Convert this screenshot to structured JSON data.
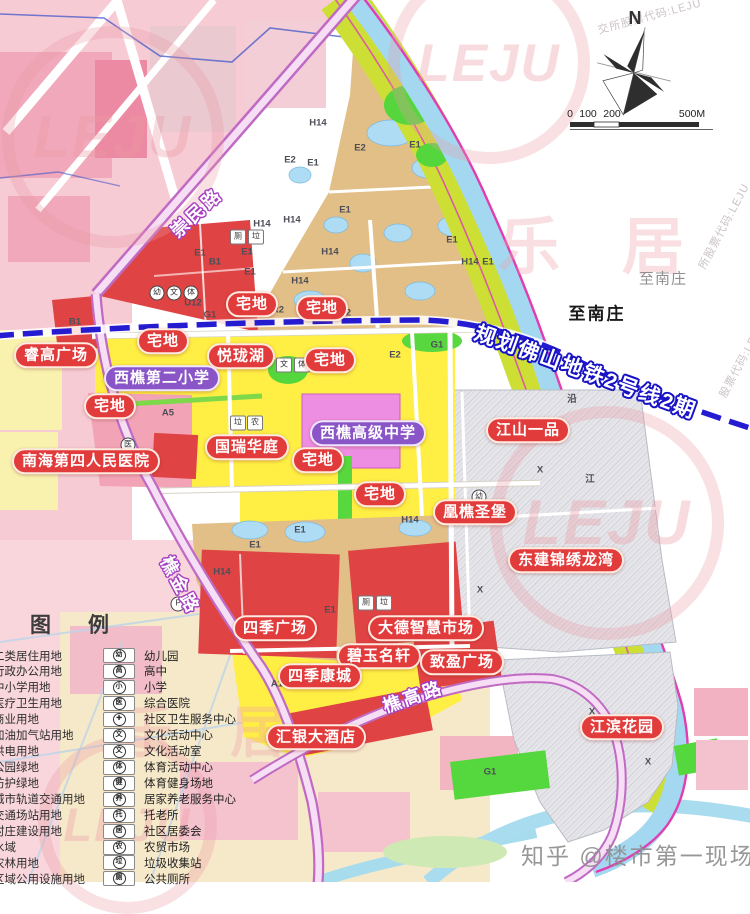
{
  "colors": {
    "bubble_red": "#e23b3b",
    "bubble_purple": "#8a55c6",
    "metro_blue": "#251bd1",
    "road_purple": "#c06ac4",
    "boundary_magenta": "#e23cb3"
  },
  "compass": {
    "label": "N"
  },
  "scale_bar": {
    "ticks": [
      "0",
      "100",
      "200",
      "500M"
    ]
  },
  "destinations": [
    {
      "text": "至南庄",
      "style": "faint",
      "x": 663,
      "y": 278
    },
    {
      "text": "至南庄",
      "style": "bold",
      "x": 597,
      "y": 312
    }
  ],
  "metro_label": {
    "text": "规划佛山地铁2号线2期",
    "x": 586,
    "y": 371,
    "rot": 20
  },
  "road_labels": [
    {
      "text": "崇民路",
      "x": 196,
      "y": 212,
      "rot": -43
    },
    {
      "text": "樵金路",
      "x": 181,
      "y": 585,
      "rot": 62
    },
    {
      "text": "樵高路",
      "x": 413,
      "y": 696,
      "rot": -19
    }
  ],
  "bubbles": [
    {
      "text": "宅地",
      "type": "red",
      "x": 252,
      "y": 304
    },
    {
      "text": "宅地",
      "type": "red",
      "x": 322,
      "y": 308
    },
    {
      "text": "睿高广场",
      "type": "red",
      "x": 56,
      "y": 355
    },
    {
      "text": "宅地",
      "type": "red",
      "x": 163,
      "y": 341
    },
    {
      "text": "悦珑湖",
      "type": "red",
      "x": 241,
      "y": 356
    },
    {
      "text": "宅地",
      "type": "red",
      "x": 330,
      "y": 360
    },
    {
      "text": "西樵第二小学",
      "type": "purple",
      "x": 162,
      "y": 378
    },
    {
      "text": "宅地",
      "type": "red",
      "x": 110,
      "y": 406
    },
    {
      "text": "南海第四人民医院",
      "type": "red",
      "x": 86,
      "y": 461
    },
    {
      "text": "国瑞华庭",
      "type": "red",
      "x": 247,
      "y": 447
    },
    {
      "text": "西樵高级中学",
      "type": "purple",
      "x": 368,
      "y": 433
    },
    {
      "text": "宅地",
      "type": "red",
      "x": 318,
      "y": 460
    },
    {
      "text": "江山一品",
      "type": "red",
      "x": 528,
      "y": 430
    },
    {
      "text": "宅地",
      "type": "red",
      "x": 380,
      "y": 494
    },
    {
      "text": "凰樵圣堡",
      "type": "red",
      "x": 475,
      "y": 512
    },
    {
      "text": "东建锦绣龙湾",
      "type": "red",
      "x": 566,
      "y": 560
    },
    {
      "text": "四季广场",
      "type": "red",
      "x": 275,
      "y": 628
    },
    {
      "text": "大德智慧市场",
      "type": "red",
      "x": 426,
      "y": 628
    },
    {
      "text": "碧玉名轩",
      "type": "red",
      "x": 379,
      "y": 656
    },
    {
      "text": "致盈广场",
      "type": "red",
      "x": 462,
      "y": 662
    },
    {
      "text": "四季康城",
      "type": "red",
      "x": 320,
      "y": 676
    },
    {
      "text": "汇银大酒店",
      "type": "red",
      "x": 316,
      "y": 737
    },
    {
      "text": "江滨花园",
      "type": "red",
      "x": 622,
      "y": 727
    }
  ],
  "legend": {
    "title": "图　例",
    "zones": [
      "二类居住用地",
      "行政办公用地",
      "中小学用地",
      "医疗卫生用地",
      "商业用地",
      "加油加气站用地",
      "供电用地",
      "公园绿地",
      "防护绿地",
      "城市轨道交通用地",
      "交通场站用地",
      "村庄建设用地",
      "水域",
      "农林用地",
      "区域公用设施用地"
    ],
    "facilities": [
      {
        "glyph": "幼",
        "label": "幼儿园"
      },
      {
        "glyph": "高",
        "label": "高中"
      },
      {
        "glyph": "小",
        "label": "小学"
      },
      {
        "glyph": "医",
        "label": "综合医院"
      },
      {
        "glyph": "✚",
        "label": "社区卫生服务中心"
      },
      {
        "glyph": "文",
        "label": "文化活动中心"
      },
      {
        "glyph": "文",
        "label": "文化活动室"
      },
      {
        "glyph": "体",
        "label": "体育活动中心"
      },
      {
        "glyph": "健",
        "label": "体育健身场地"
      },
      {
        "glyph": "养",
        "label": "居家养老服务中心"
      },
      {
        "glyph": "托",
        "label": "托老所"
      },
      {
        "glyph": "居",
        "label": "社区居委会"
      },
      {
        "glyph": "农",
        "label": "农贸市场"
      },
      {
        "glyph": "垃",
        "label": "垃圾收集站"
      },
      {
        "glyph": "厕",
        "label": "公共厕所"
      }
    ]
  },
  "zone_codes": [
    [
      "H14",
      318,
      123
    ],
    [
      "E2",
      290,
      160
    ],
    [
      "E1",
      313,
      163
    ],
    [
      "E1",
      345,
      210
    ],
    [
      "H14",
      292,
      220
    ],
    [
      "H14",
      262,
      224
    ],
    [
      "B1",
      215,
      262
    ],
    [
      "E1",
      200,
      253
    ],
    [
      "E1",
      247,
      252
    ],
    [
      "H14",
      330,
      252
    ],
    [
      "E1",
      250,
      272
    ],
    [
      "H14",
      300,
      281
    ],
    [
      "E1",
      415,
      145
    ],
    [
      "E2",
      360,
      148
    ],
    [
      "E1",
      452,
      240
    ],
    [
      "H14",
      470,
      262
    ],
    [
      "E1",
      488,
      262
    ],
    [
      "R2",
      278,
      310
    ],
    [
      "R2",
      345,
      313
    ],
    [
      "G1",
      210,
      315
    ],
    [
      "U12",
      193,
      303
    ],
    [
      "B1",
      75,
      322
    ],
    [
      "A5",
      168,
      413
    ],
    [
      "E2",
      395,
      355
    ],
    [
      "G1",
      437,
      345
    ],
    [
      "E1",
      300,
      530
    ],
    [
      "E1",
      255,
      545
    ],
    [
      "H14",
      222,
      572
    ],
    [
      "E1",
      330,
      610
    ],
    [
      "H14",
      410,
      520
    ],
    [
      "X",
      540,
      470
    ],
    [
      "X",
      480,
      590
    ],
    [
      "X",
      592,
      712
    ],
    [
      "X",
      648,
      762
    ],
    [
      "G1",
      490,
      772
    ],
    [
      "A1",
      277,
      684
    ],
    [
      "A1",
      300,
      684
    ],
    [
      "沿",
      572,
      398
    ],
    [
      "江",
      590,
      478
    ]
  ],
  "poi_icons": [
    {
      "g": "幼",
      "x": 157,
      "y": 293,
      "s": "c"
    },
    {
      "g": "文",
      "x": 174,
      "y": 293,
      "s": "c"
    },
    {
      "g": "体",
      "x": 191,
      "y": 293,
      "s": "c"
    },
    {
      "g": "厕",
      "x": 238,
      "y": 237,
      "s": "s"
    },
    {
      "g": "垃",
      "x": 256,
      "y": 237,
      "s": "s"
    },
    {
      "g": "文",
      "x": 284,
      "y": 365,
      "s": "s"
    },
    {
      "g": "体",
      "x": 302,
      "y": 365,
      "s": "s"
    },
    {
      "g": "垃",
      "x": 238,
      "y": 423,
      "s": "s"
    },
    {
      "g": "农",
      "x": 255,
      "y": 423,
      "s": "s"
    },
    {
      "g": "医",
      "x": 128,
      "y": 445,
      "s": "c"
    },
    {
      "g": "P",
      "x": 178,
      "y": 604,
      "s": "c"
    },
    {
      "g": "厕",
      "x": 366,
      "y": 603,
      "s": "s"
    },
    {
      "g": "垃",
      "x": 384,
      "y": 603,
      "s": "s"
    },
    {
      "g": "幼",
      "x": 479,
      "y": 497,
      "s": "c"
    }
  ],
  "watermarks": {
    "rings": [
      {
        "x": 388,
        "y": -38,
        "d": 178
      },
      {
        "x": 2,
        "y": 26,
        "d": 198
      },
      {
        "x": 490,
        "y": 406,
        "d": 210
      },
      {
        "x": 38,
        "y": 735,
        "d": 155
      }
    ],
    "ring_text": "LEJU",
    "chars": [
      {
        "t": "乐　居",
        "x": 498,
        "y": 196,
        "s": 62
      },
      {
        "t": "乐　居",
        "x": 118,
        "y": 688,
        "s": 56
      }
    ],
    "codes": [
      {
        "t": "交所股票代码:LEJU",
        "x": 596,
        "y": 8,
        "r": -15
      },
      {
        "t": "所股票代码:LEJU",
        "x": 676,
        "y": 218,
        "r": -62
      },
      {
        "t": "股票代码:LEJU",
        "x": 700,
        "y": 352,
        "r": -62
      }
    ],
    "credit": {
      "text": "知乎 @楼市第一现场",
      "x": 521,
      "y": 837
    }
  }
}
